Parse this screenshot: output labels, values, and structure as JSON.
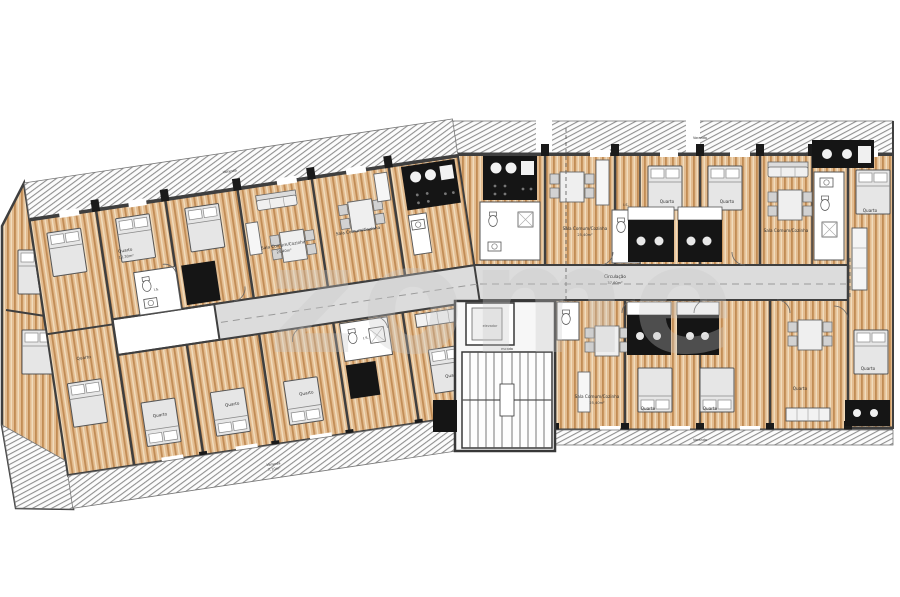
{
  "watermark": "zome",
  "labels": {
    "circulation": "Circulação",
    "circulation_area": "37,60m²",
    "elevator": "elevador",
    "stairs": "escada",
    "living": "Sala Comum/Cozinha",
    "living_area": "25,40m²",
    "bedroom": "Quarto",
    "bedroom_area": "12,30m²",
    "bath": "I.S.",
    "bath_area": "4,50m²",
    "balcony": "Varanda",
    "balcony_area": "7,10m²"
  },
  "colors": {
    "wood": "#e3bc90",
    "wood_stripe": "#c18c55",
    "wall": "#3f3f3f",
    "kitchen_block": "#151515",
    "corridor": "#dcdcdc",
    "hatch_line": "#909090",
    "furniture": "#e6e6e6",
    "watermark": "#c8c8c8"
  }
}
